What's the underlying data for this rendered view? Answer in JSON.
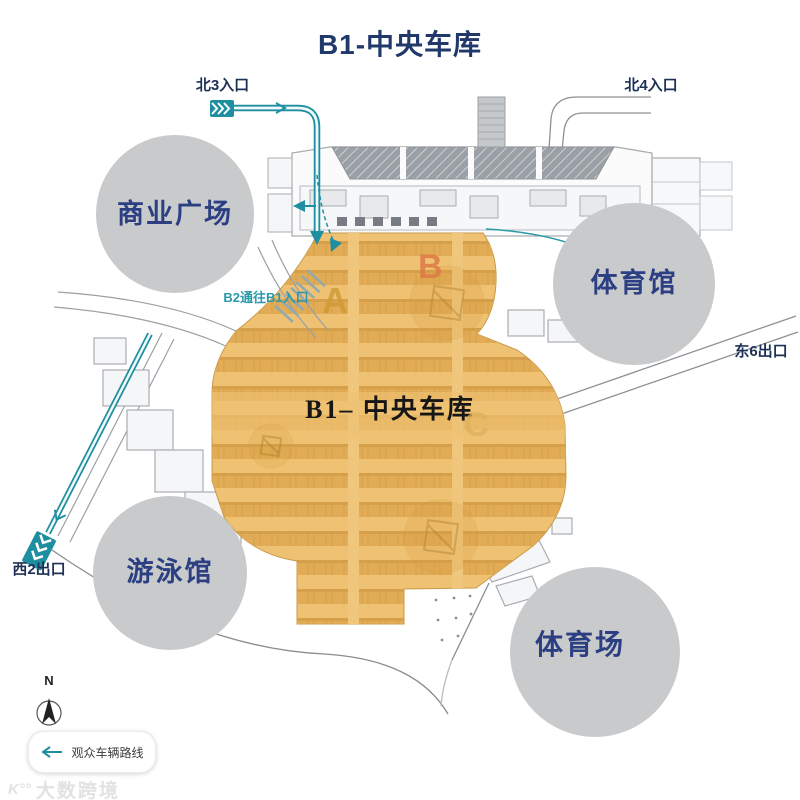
{
  "title": "B1-中央车库",
  "map": {
    "center_label": "B1– 中央车库",
    "ramp_note": "B2通往B1入口",
    "zones": [
      {
        "label": "A"
      },
      {
        "label": "B"
      },
      {
        "label": "C"
      }
    ],
    "entrances": [
      {
        "label": "北3入口"
      },
      {
        "label": "北4入口"
      }
    ],
    "exits": [
      {
        "label": "东6出口"
      },
      {
        "label": "西2出口"
      }
    ],
    "venues": [
      {
        "label": "商业广场"
      },
      {
        "label": "体育馆"
      },
      {
        "label": "游泳馆"
      },
      {
        "label": "体育场"
      }
    ]
  },
  "compass": {
    "north": "N"
  },
  "legend": {
    "route_label": "观众车辆路线"
  },
  "watermark": {
    "logo": "K°°",
    "name": "大数跨境"
  },
  "colors": {
    "title_navy": "#21386b",
    "venue_text": "#2b3f82",
    "venue_circle": "#c9cacb",
    "parking_fill": "#eec173",
    "parking_stripe": "#dfaa52",
    "route_teal": "#1e8fa0",
    "road_gray": "#8d9298",
    "zone_a": "#cf9a33",
    "zone_b": "#dd7a45",
    "zone_c": "#ddb05b",
    "center_label_color": "#161616"
  }
}
